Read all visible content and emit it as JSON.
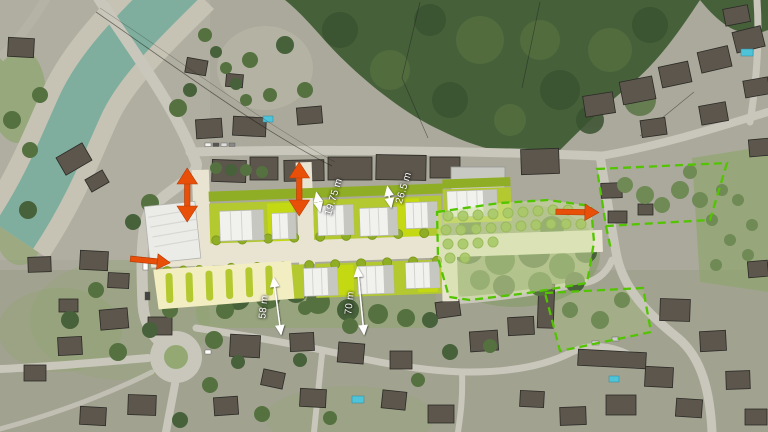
{
  "map": {
    "kind": "aerial-masterplan-overlay",
    "dimensions": {
      "strip_north": {
        "text": "19.75 m"
      },
      "strip_mid": {
        "text": "26.5 m"
      },
      "offset_west": {
        "text": "58 m"
      },
      "offset_east": {
        "text": "70 m"
      }
    },
    "arrows": {
      "west_entry": {
        "icon": "entry-arrow-icon",
        "direction": "right"
      },
      "east_entry": {
        "icon": "entry-arrow-icon",
        "direction": "right"
      },
      "north_link_1": {
        "icon": "two-way-link-arrow-icon",
        "direction": "vertical-both"
      },
      "north_link_2": {
        "icon": "two-way-link-arrow-icon",
        "direction": "vertical-both"
      }
    },
    "zones": {
      "park": "dashed-boundary-park",
      "parking_north_east": "dashed-boundary-parking",
      "field_south_east": "dashed-boundary-field"
    }
  },
  "colors": {
    "accent_orange": "#E8500A",
    "plan_green": "#B3C92F",
    "lime_highlight": "#CADE0A",
    "hedge_green": "#90AE25",
    "street_beige": "#E9E4D2",
    "building_white": "#F1F1EE",
    "building_shade": "#C7C7C2",
    "parking_cream": "#F3EEC2",
    "park_overlay": "#CFE29E",
    "park_tree": "#A9C968",
    "boundary_dash": "#52C400",
    "dim_white": "#FFFFFF",
    "water": "#7FAE9E",
    "road": "#C9C7BB",
    "forest": "#46603A",
    "canopy": "#54713F",
    "roof_dark": "#5C564C",
    "grass": "#8FA56D"
  }
}
